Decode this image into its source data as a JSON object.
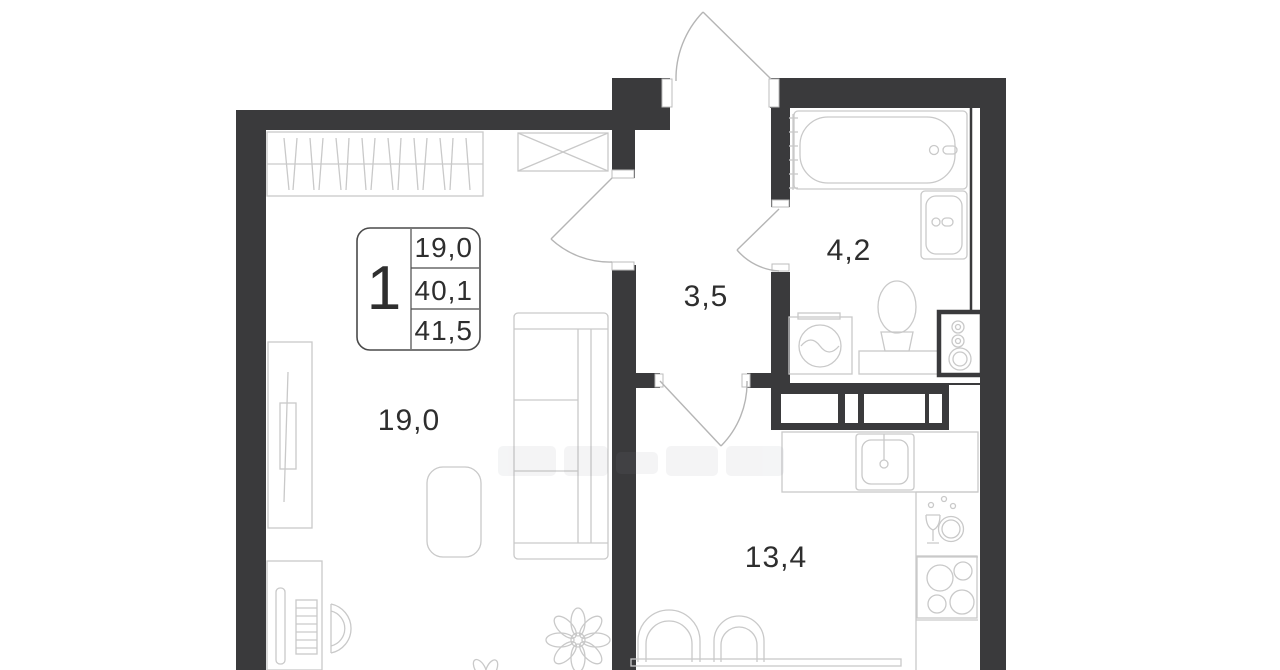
{
  "floor_plan": {
    "unit_badge": {
      "rooms_count": "1",
      "area_values": [
        "19,0",
        "40,1",
        "41,5"
      ]
    },
    "room_labels": {
      "living_room": "19,0",
      "hallway": "3,5",
      "bathroom": "4,2",
      "kitchen": "13,4"
    },
    "colors": {
      "wall": "#3a3a3c",
      "furniture_line": "#c9c9c9",
      "door_line": "#b5b5b5",
      "text": "#2e2e2e",
      "background": "#ffffff"
    },
    "fixtures": [
      "entrance-door",
      "living-room-door",
      "bathroom-door",
      "kitchen-door",
      "wardrobe-with-hangers",
      "crossed-storage-cabinet",
      "sofa",
      "tv-console",
      "desk-with-computer",
      "desk-chair",
      "armchair",
      "plant",
      "bathtub",
      "towel-rail",
      "bathroom-sink",
      "toilet",
      "washing-machine",
      "utility-riser",
      "ventilation-shafts",
      "kitchen-sink",
      "dishwasher-area",
      "stove-hob",
      "dining-table",
      "dining-chairs"
    ]
  }
}
